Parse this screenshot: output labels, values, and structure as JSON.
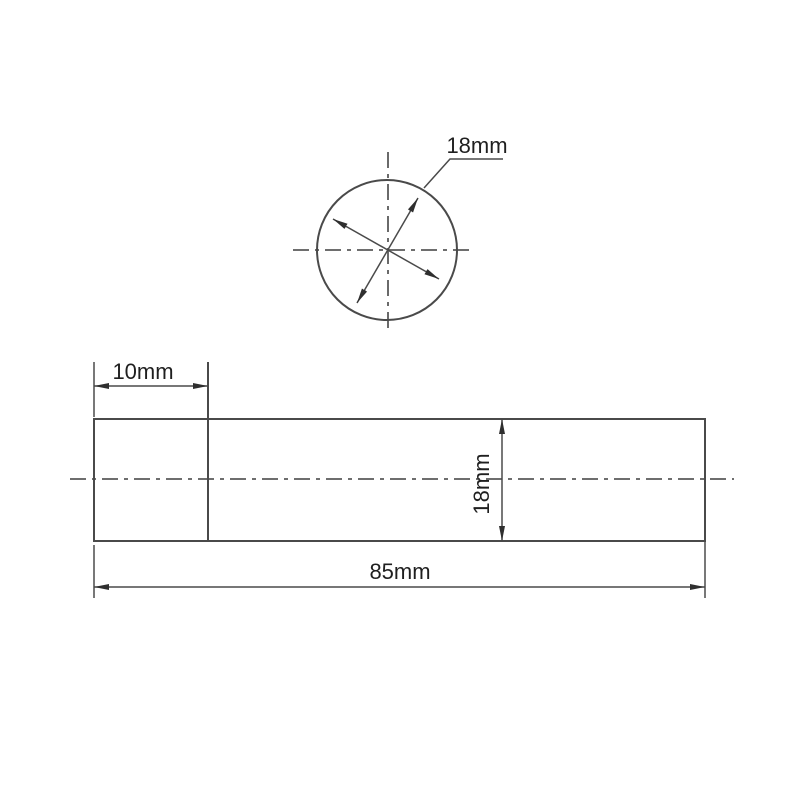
{
  "drawing": {
    "type": "engineering-dimension-drawing",
    "part": "cylindrical rod, end view and side view",
    "colors": {
      "background": "#ffffff",
      "object_line": "#4a4a4a",
      "center_line": "#5a5a5a",
      "text": "#1f1f1f"
    },
    "end_view": {
      "diameter_label": "18mm"
    },
    "side_view": {
      "step_length_label": "10mm",
      "height_label": "18mm",
      "total_length_label": "85mm"
    }
  }
}
